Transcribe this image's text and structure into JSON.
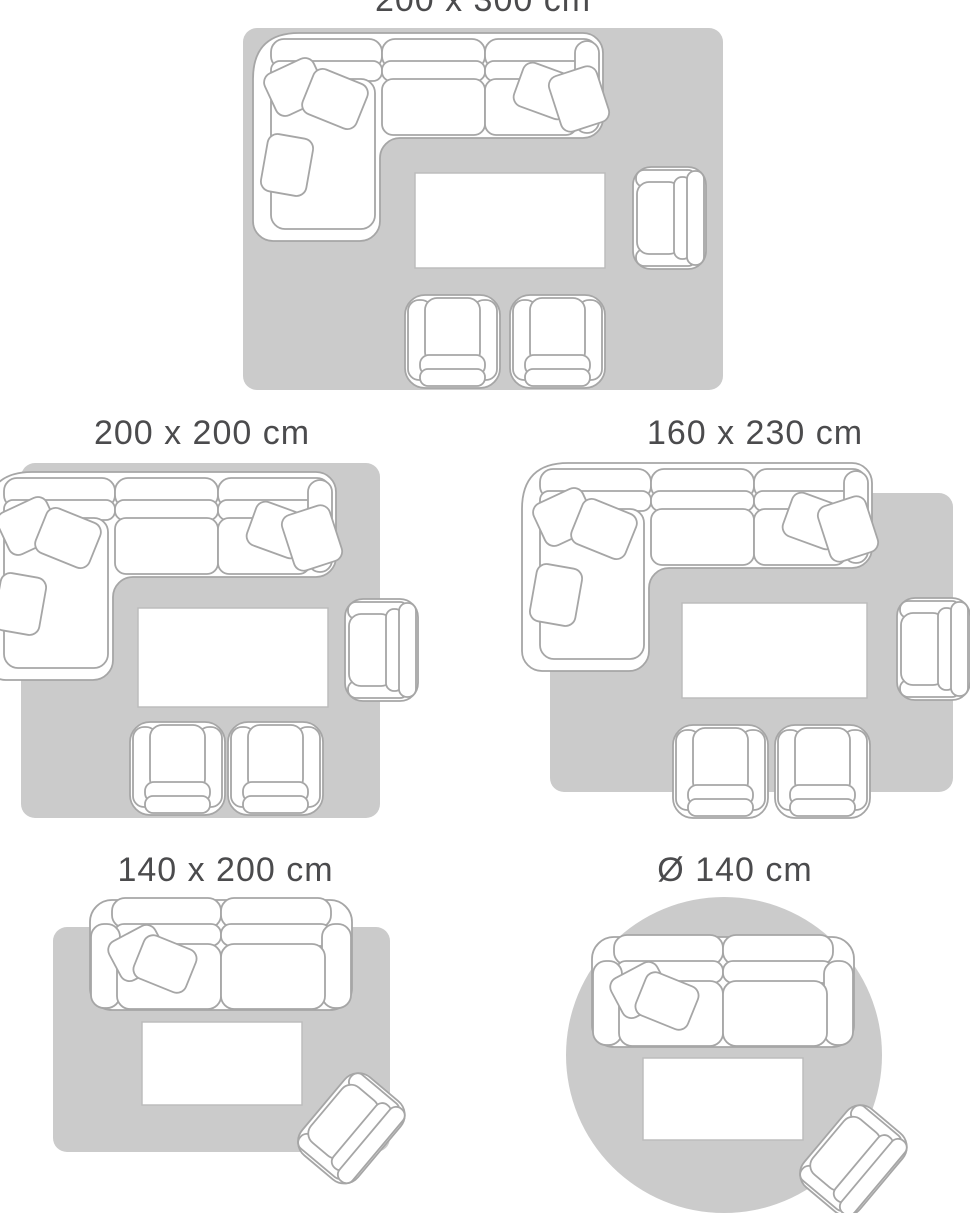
{
  "page": {
    "title": "Rug size guide",
    "background": "#ffffff"
  },
  "colors": {
    "rug_fill": "#cbcbcb",
    "furniture_fill": "#ffffff",
    "furniture_outline": "#a6a6a6",
    "table_outline": "#bdbdbd",
    "label_text": "#4b4b4d"
  },
  "size_guide": {
    "cards": [
      {
        "label": "200 x 300 cm",
        "shape": "rectangular"
      },
      {
        "label": "200 x 200 cm",
        "shape": "rectangular"
      },
      {
        "label": "160 x 230 cm",
        "shape": "rectangular"
      },
      {
        "label": "140 x 200 cm",
        "shape": "rectangular"
      },
      {
        "label": "Ø 140 cm",
        "shape": "round"
      }
    ]
  }
}
